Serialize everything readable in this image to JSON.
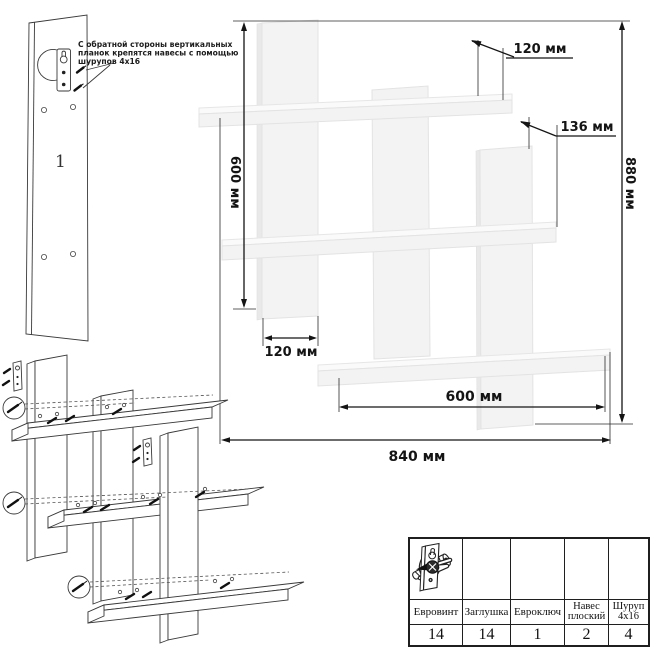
{
  "annotation": {
    "text_line1": "С обратной стороны вертикальных",
    "text_line2": "планок крепятся навесы с помощью",
    "text_line3": "шурупов 4х16",
    "part_number": "1"
  },
  "dimensions": {
    "shelf_depth_top": "120 мм",
    "plank_height_right": "136 мм",
    "total_height": "880 мм",
    "plank_height_left": "600 мм",
    "plank_width_bottom": "120 мм",
    "shelf_span_bottom": "600 мм",
    "total_width": "840 мм"
  },
  "hardware_table": {
    "columns": [
      {
        "icon": "euro-screw-icon",
        "label_line1": "Евровинт",
        "label_line2": "",
        "qty": "14"
      },
      {
        "icon": "plug-cap-icon",
        "label_line1": "Заглушка",
        "label_line2": "",
        "qty": "14"
      },
      {
        "icon": "hex-key-icon",
        "label_line1": "Евроключ",
        "label_line2": "",
        "qty": "1"
      },
      {
        "icon": "flat-hanger-icon",
        "label_line1": "Навес",
        "label_line2": "плоский",
        "qty": "2"
      },
      {
        "icon": "screw-4x16-icon",
        "label_line1": "Шуруп",
        "label_line2": "4х16",
        "qty": "4"
      }
    ]
  },
  "colors": {
    "line": "#141414",
    "panel_fill": "#f3f3f3",
    "panel_edge": "#e3e3e3",
    "background": "#ffffff"
  }
}
